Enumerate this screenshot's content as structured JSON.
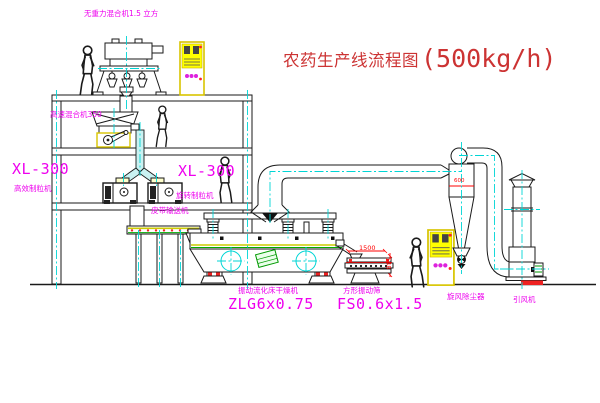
{
  "title": {
    "text": "农药生产线流程图",
    "capacity": "(500kg/h)"
  },
  "labels": {
    "gravity_free_mixer": "无重力混合机1.5 立方",
    "high_speed_mixer": "高速混合机350",
    "granulator_left_model": "XL-300",
    "granulator_left_name": "高效制粒机",
    "granulator_right_model": "XL-300",
    "granulator_right_name": "旋转制粒机",
    "belt_conveyor": "皮带输送机",
    "dryer_name": "振动流化床干燥机",
    "dryer_model": "ZLG6x0.75",
    "screen_name": "方形振动筛",
    "screen_model": "FS0.6x1.5",
    "cyclone": "旋风除尘器",
    "fan": "引风机"
  },
  "dimensions": {
    "screen_length": "1500",
    "screen_height": "548",
    "cyclone_diameter": "600"
  },
  "colors": {
    "label_magenta": "#ee00ee",
    "title_red": "#cc3333",
    "dimension_red": "#ff0000",
    "centerline_cyan": "#00d5d5",
    "cabinet_yellow": "#ffff00",
    "motor_green": "#009900"
  }
}
